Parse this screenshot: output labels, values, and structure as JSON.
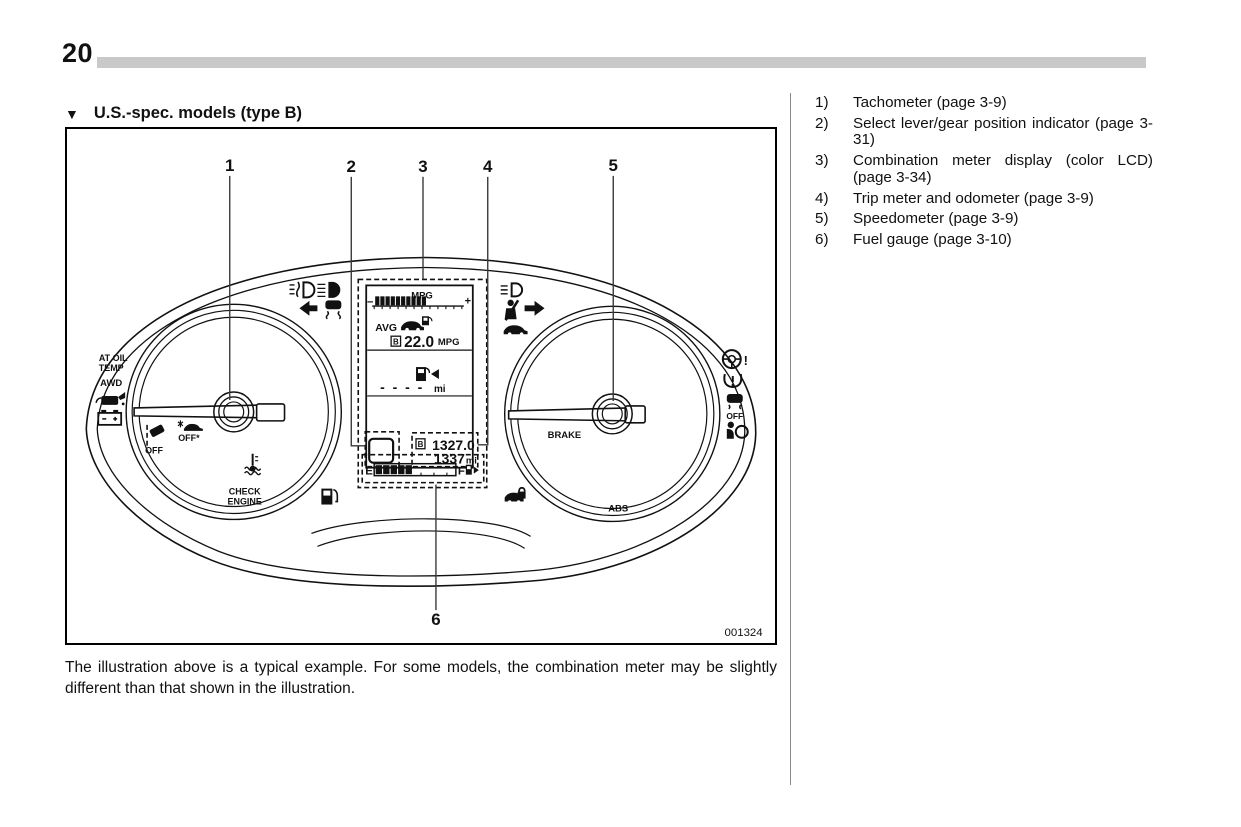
{
  "colors": {
    "ink": "#111111",
    "header_bar": "#c9c9c9",
    "separator": "#8a8a8a",
    "background": "#ffffff"
  },
  "page": {
    "number": "20"
  },
  "section": {
    "marker": "▼",
    "title": "U.S.-spec. models (type B)"
  },
  "figure": {
    "id": "001324",
    "caption": "The illustration above is a typical example. For some models, the combination meter may be slightly different than that shown in the illustration."
  },
  "legend": {
    "items": [
      {
        "num": "1)",
        "text": "Tachometer (page 3-9)"
      },
      {
        "num": "2)",
        "text": "Select lever/gear position indicator (page 3-31)"
      },
      {
        "num": "3)",
        "text": "Combination meter display (color LCD) (page 3-34)"
      },
      {
        "num": "4)",
        "text": "Trip meter and odometer (page 3-9)"
      },
      {
        "num": "5)",
        "text": "Speedometer (page 3-9)"
      },
      {
        "num": "6)",
        "text": "Fuel gauge (page 3-10)"
      }
    ]
  },
  "cluster": {
    "callouts": {
      "c1": "1",
      "c2": "2",
      "c3": "3",
      "c4": "4",
      "c5": "5",
      "c6": "6"
    },
    "texts": {
      "at_oil": "AT OIL",
      "temp": "TEMP",
      "awd": "AWD",
      "off_lane": "OFF",
      "off_eyesight": "OFF*",
      "off_vdc": "OFF",
      "check": "CHECK",
      "engine": "ENGINE",
      "brake": "BRAKE",
      "abs": "ABS",
      "excl": "!",
      "lcd": {
        "mpg_title": "MPG",
        "minus": "−",
        "plus": "+",
        "avg": "AVG",
        "b": "B",
        "avg_value": "22.0",
        "avg_unit": "MPG",
        "range_value": "- - - -",
        "range_unit": "mi",
        "trip_b": "B",
        "trip_value": "1327.0",
        "odo_value": "1337",
        "odo_unit": "mi",
        "fuel_e": "E",
        "fuel_f": "F"
      }
    }
  }
}
